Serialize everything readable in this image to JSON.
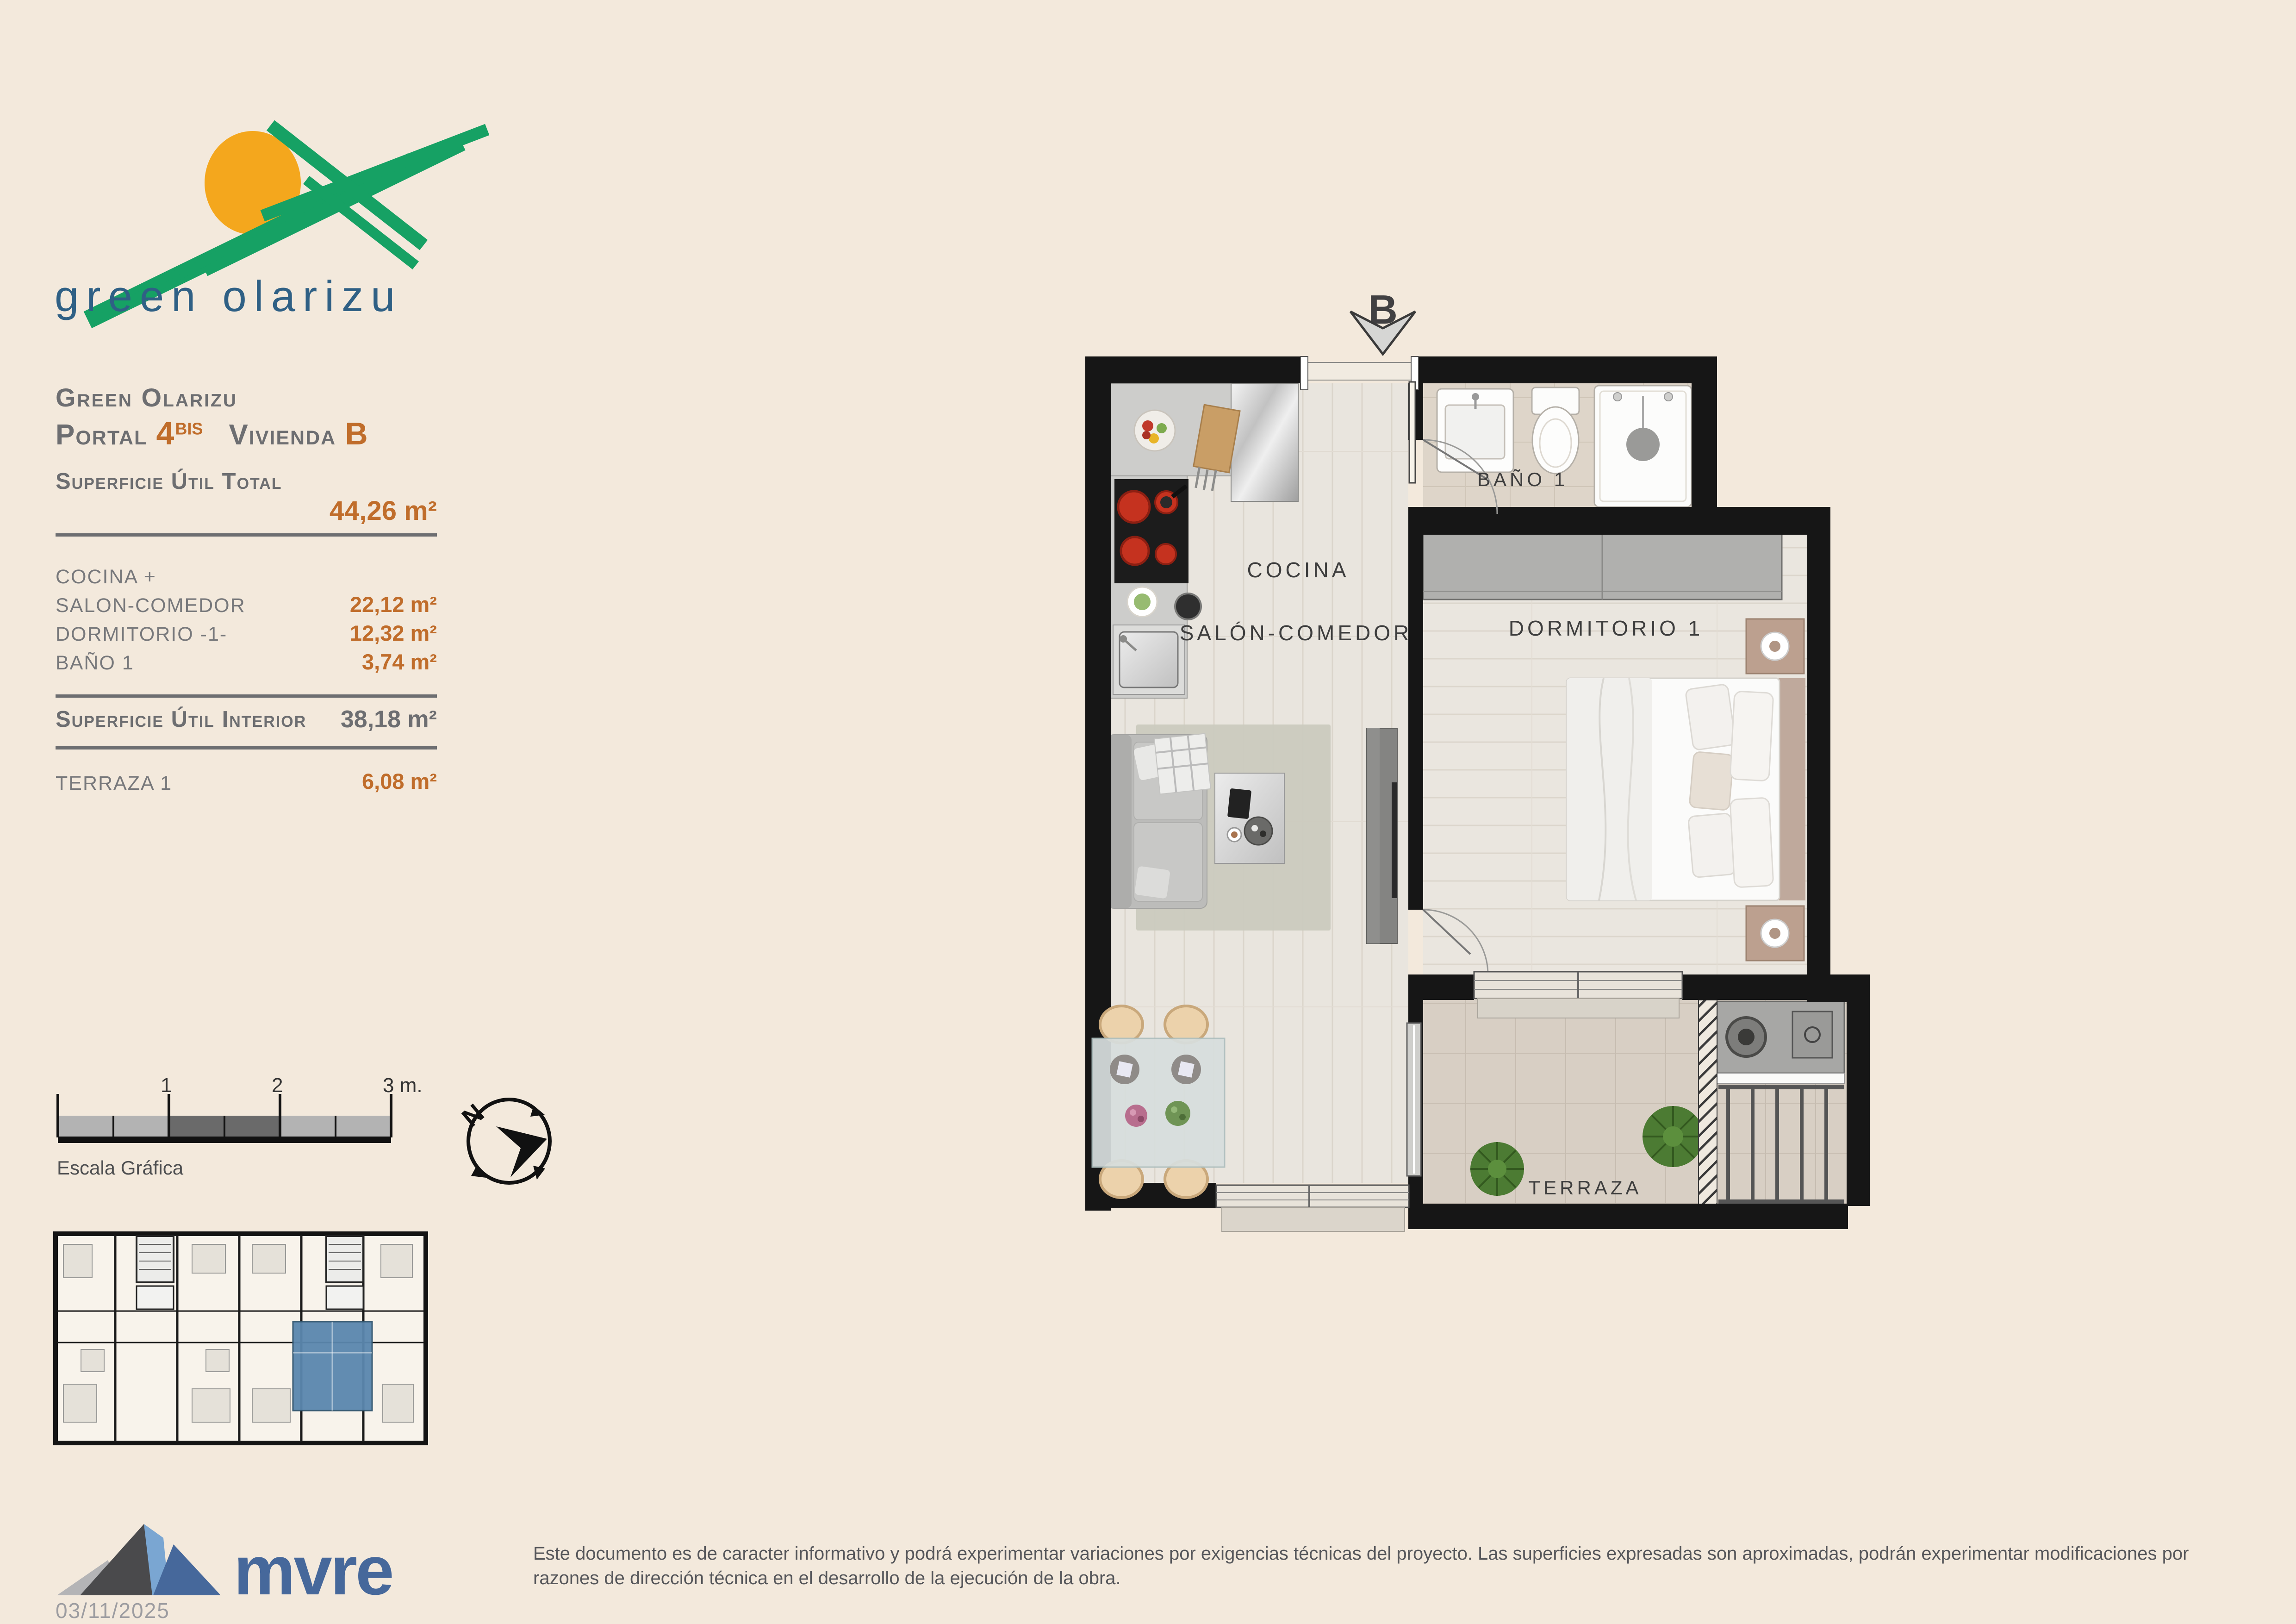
{
  "colors": {
    "page_bg": "#f3e9dc",
    "accent": "#c06d2b",
    "heading_gray": "#6d6e71",
    "text_gray": "#77787b",
    "label_dark": "#3e3e3e",
    "brand_green": "#16a164",
    "brand_sun": "#f4a71d",
    "brand_blue": "#2f6085",
    "mvre_blue": "#46689b",
    "unit_highlight": "#5b87ae",
    "wall_black": "#161616"
  },
  "brand": {
    "logo_text": "green olarizu"
  },
  "title_block": {
    "project": "Green Olarizu",
    "portal_label": "Portal ",
    "portal_number": "4",
    "portal_suffix": "BIS",
    "unit_label": "Vivienda ",
    "unit_letter": "B"
  },
  "surfaces": {
    "total_label": "Superficie Útil Total",
    "total_value": "44,26 m²",
    "rows": [
      {
        "label": "COCINA +",
        "value": ""
      },
      {
        "label": "SALON-COMEDOR",
        "value": "22,12 m²"
      },
      {
        "label": "DORMITORIO -1-",
        "value": "12,32 m²"
      },
      {
        "label": "BAÑO 1",
        "value": "3,74 m²"
      }
    ],
    "interior_label": "Superficie Útil Interior",
    "interior_value": "38,18 m²",
    "terrace_label": "TERRAZA 1",
    "terrace_value": "6,08 m²"
  },
  "scale_bar": {
    "labels": [
      "1",
      "2",
      "3 m."
    ],
    "caption": "Escala Gráfica"
  },
  "compass": {
    "north": "N"
  },
  "plan": {
    "entrance_label": "B",
    "rooms": {
      "kitchen": "COCINA",
      "living": "SALÓN-COMEDOR",
      "bath": "BAÑO 1",
      "bedroom": "DORMITORIO 1",
      "terrace": "TERRAZA"
    }
  },
  "footer": {
    "brand": "mvre",
    "date": "03/11/2025",
    "disclaimer_line1": "Este documento es de caracter informativo y podrá experimentar variaciones por exigencias técnicas del proyecto. Las superficies expresadas son aproximadas, podrán experimentar modificaciones por",
    "disclaimer_line2": "razones de dirección técnica en el desarrollo de la ejecución de la obra."
  }
}
